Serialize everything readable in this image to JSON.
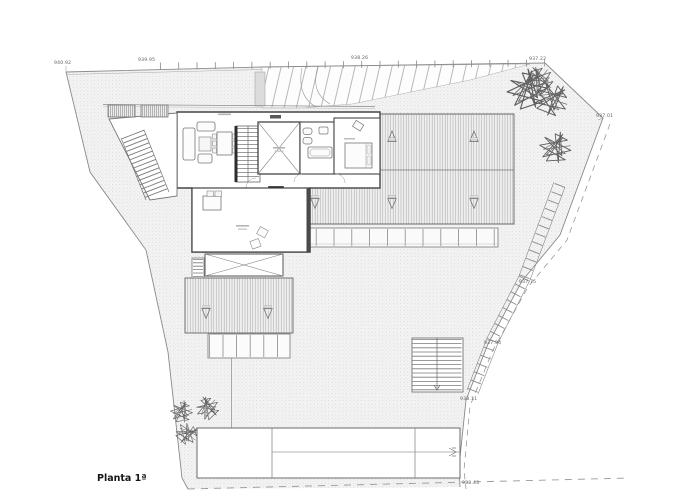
{
  "plan": {
    "title": "Planta 1ª",
    "elevations": {
      "nw": "940.92",
      "n1": "939.95",
      "n2": "938.26",
      "ne": "937.22",
      "e": "937.01",
      "se1": "937.75",
      "se2": "937.94",
      "se3": "938.11",
      "s": "938.43"
    }
  },
  "colors": {
    "paper": "#ffffff",
    "terrain_fill": "#f3f3f3",
    "terrain_dot": "#c9c9c9",
    "boundary_line": "#8a8a8a",
    "wall": "#333333",
    "roof_stripe": "#a9a9a9",
    "label_text": "#5f5f5f",
    "title_text": "#161616"
  }
}
